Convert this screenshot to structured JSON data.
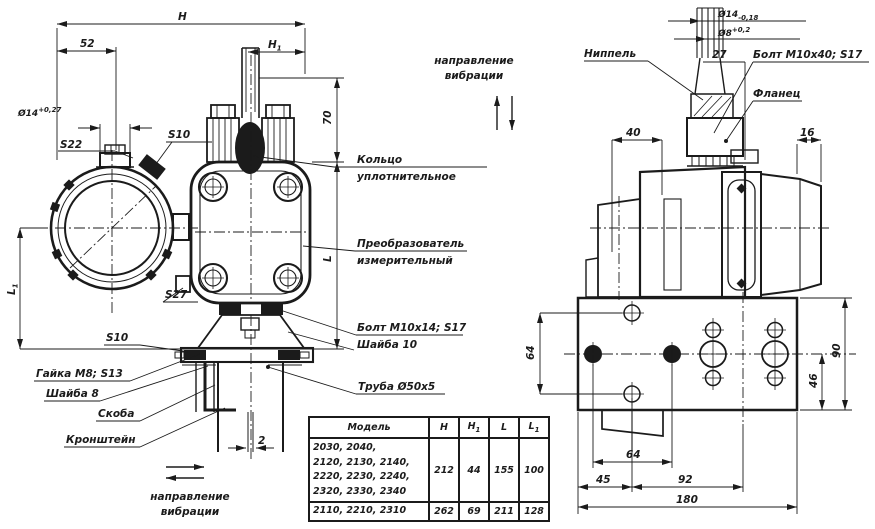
{
  "colors": {
    "ink": "#1b1b1b",
    "paper": "#ffffff"
  },
  "dims": {
    "h": "Н",
    "h1_main": "Н",
    "h1_sub": "1",
    "d52": "52",
    "dia14_left_main": "Ø14",
    "dia14_left_sup": "+0,27",
    "d70": "70",
    "l": "L",
    "l1_main": "L",
    "l1_sub": "1",
    "d2": "2",
    "dia14_right_main": "Ø14",
    "dia14_right_sub": "-0,18",
    "dia8_main": "Ø8",
    "dia8_sup": "+0,2",
    "d27": "27",
    "d40": "40",
    "d16": "16",
    "d64_vertical": "64",
    "d64_horizontal": "64",
    "d45": "45",
    "d92": "92",
    "d180": "180",
    "d90": "90",
    "d46": "46"
  },
  "labels": {
    "nippel": "Ниппель",
    "bolt_m10x40": "Болт М10х40; S17",
    "flanec": "Фланец",
    "kolco_line1": "Кольцо",
    "kolco_line2": "уплотнительное",
    "preobr_line1": "Преобразователь",
    "preobr_line2": "измерительный",
    "bolt_m10x14": "Болт М10х14; S17",
    "shayba10": "Шайба 10",
    "truba": "Труба Ø50х5",
    "gayka": "Гайка М8; S13",
    "shayba8": "Шайба 8",
    "skoba": "Скоба",
    "kronshteyn": "Кронштейн",
    "s22": "S22",
    "s10_top": "S10",
    "s10_bottom": "S10",
    "s27": "S27",
    "vibration_line1": "направление",
    "vibration_line2": "вибрации"
  },
  "table": {
    "headers": {
      "model": "Модель",
      "h": "Н",
      "h1_main": "Н",
      "h1_sub": "1",
      "l": "L",
      "l1_main": "L",
      "l1_sub": "1"
    },
    "rows": [
      {
        "model_lines": [
          "2030, 2040,",
          "2120, 2130, 2140,",
          "2220, 2230, 2240,",
          "2320, 2330, 2340"
        ],
        "h": "212",
        "h1": "44",
        "l": "155",
        "l1": "100"
      },
      {
        "model_lines": [
          "2110, 2210, 2310"
        ],
        "h": "262",
        "h1": "69",
        "l": "211",
        "l1": "128"
      }
    ]
  }
}
